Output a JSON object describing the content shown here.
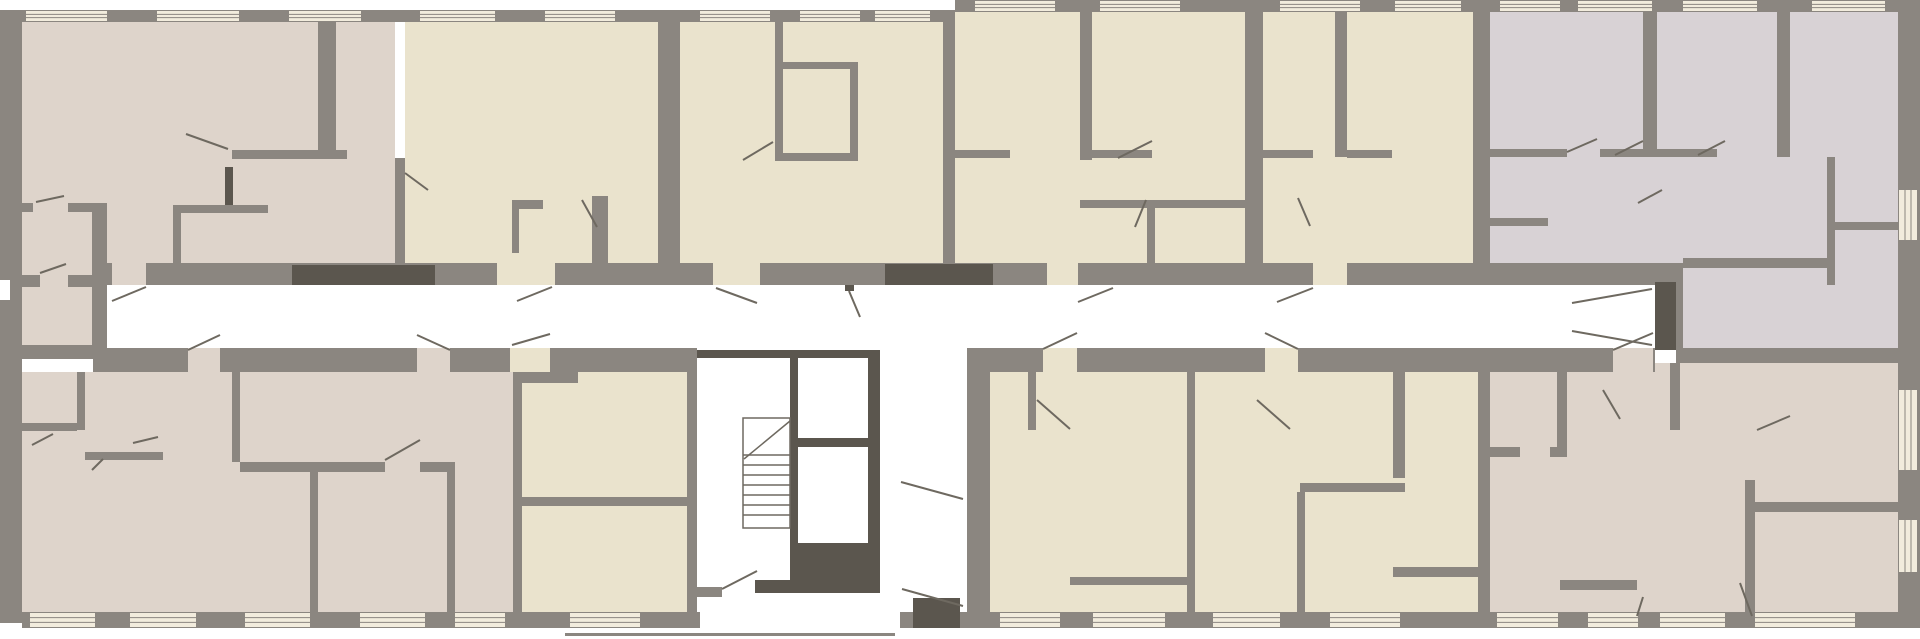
{
  "plan": {
    "width": 1920,
    "height": 639,
    "background": "#ffffff",
    "palette": {
      "wall": "#8b8680",
      "dark": "#5b564e",
      "pink": "#ded4cb",
      "cream": "#eae3cd",
      "lav": "#d8d2d5",
      "winbg": "#f2ecdd",
      "winline": "#8b8680",
      "line": "#6e6960",
      "white": "#ffffff"
    },
    "room_fills": [
      [
        22,
        22,
        373,
        241,
        "pink"
      ],
      [
        22,
        203,
        70,
        145,
        "pink"
      ],
      [
        405,
        22,
        253,
        241,
        "cream"
      ],
      [
        680,
        22,
        263,
        241,
        "cream"
      ],
      [
        955,
        12,
        290,
        251,
        "cream"
      ],
      [
        1263,
        12,
        210,
        251,
        "cream"
      ],
      [
        1490,
        12,
        408,
        273,
        "lav"
      ],
      [
        1683,
        285,
        215,
        63,
        "lav"
      ],
      [
        22,
        372,
        491,
        240,
        "pink"
      ],
      [
        522,
        372,
        165,
        240,
        "cream"
      ],
      [
        990,
        372,
        197,
        240,
        "cream"
      ],
      [
        1195,
        372,
        283,
        240,
        "cream"
      ],
      [
        1490,
        363,
        408,
        249,
        "pink"
      ]
    ],
    "walls": [
      [
        22,
        10,
        933,
        12
      ],
      [
        955,
        0,
        943,
        12
      ],
      [
        0,
        10,
        22,
        613
      ],
      [
        1898,
        0,
        22,
        628
      ],
      [
        22,
        612,
        678,
        16
      ],
      [
        900,
        612,
        1020,
        16
      ],
      [
        565,
        633,
        330,
        3
      ],
      [
        107,
        263,
        1576,
        22
      ],
      [
        93,
        348,
        604,
        24
      ],
      [
        967,
        348,
        688,
        24
      ],
      [
        22,
        345,
        85,
        14
      ],
      [
        92,
        203,
        15,
        145
      ],
      [
        22,
        275,
        85,
        12
      ],
      [
        0,
        203,
        33,
        9
      ],
      [
        68,
        203,
        24,
        9
      ],
      [
        658,
        22,
        22,
        263
      ],
      [
        943,
        12,
        12,
        273
      ],
      [
        1245,
        12,
        18,
        273
      ],
      [
        1473,
        10,
        17,
        275
      ],
      [
        318,
        22,
        18,
        135
      ],
      [
        232,
        150,
        115,
        9
      ],
      [
        395,
        158,
        10,
        105
      ],
      [
        173,
        205,
        8,
        58
      ],
      [
        173,
        205,
        95,
        8
      ],
      [
        512,
        200,
        7,
        53
      ],
      [
        512,
        200,
        31,
        9
      ],
      [
        592,
        196,
        16,
        67
      ],
      [
        775,
        22,
        8,
        138
      ],
      [
        783,
        62,
        75,
        7
      ],
      [
        850,
        62,
        8,
        98
      ],
      [
        775,
        153,
        83,
        8
      ],
      [
        1080,
        12,
        12,
        148
      ],
      [
        955,
        150,
        55,
        8
      ],
      [
        1092,
        150,
        60,
        8
      ],
      [
        1080,
        200,
        165,
        8
      ],
      [
        1147,
        208,
        8,
        55
      ],
      [
        1335,
        10,
        12,
        147
      ],
      [
        1263,
        150,
        50,
        8
      ],
      [
        1347,
        150,
        45,
        8
      ],
      [
        1643,
        10,
        14,
        147
      ],
      [
        1490,
        149,
        77,
        8
      ],
      [
        1600,
        149,
        43,
        8
      ],
      [
        1777,
        10,
        13,
        147
      ],
      [
        1657,
        149,
        60,
        8
      ],
      [
        1827,
        157,
        8,
        128
      ],
      [
        1835,
        222,
        63,
        8
      ],
      [
        1683,
        258,
        144,
        10
      ],
      [
        1490,
        218,
        58,
        8
      ],
      [
        1676,
        285,
        7,
        63
      ],
      [
        1676,
        348,
        222,
        15
      ],
      [
        513,
        372,
        9,
        240
      ],
      [
        687,
        348,
        10,
        264
      ],
      [
        967,
        372,
        23,
        240
      ],
      [
        1187,
        348,
        8,
        264
      ],
      [
        1478,
        348,
        12,
        264
      ],
      [
        77,
        372,
        8,
        58
      ],
      [
        22,
        423,
        55,
        8
      ],
      [
        232,
        372,
        8,
        90
      ],
      [
        240,
        462,
        215,
        10
      ],
      [
        310,
        472,
        8,
        140
      ],
      [
        447,
        462,
        8,
        150
      ],
      [
        85,
        452,
        78,
        8
      ],
      [
        522,
        372,
        56,
        11
      ],
      [
        522,
        497,
        165,
        9
      ],
      [
        1028,
        372,
        8,
        58
      ],
      [
        1070,
        577,
        117,
        8
      ],
      [
        1393,
        348,
        12,
        130
      ],
      [
        1300,
        483,
        105,
        9
      ],
      [
        1297,
        492,
        8,
        120
      ],
      [
        1393,
        567,
        85,
        10
      ],
      [
        1557,
        363,
        10,
        84
      ],
      [
        1490,
        447,
        77,
        10
      ],
      [
        1670,
        363,
        10,
        67
      ],
      [
        1745,
        480,
        10,
        132
      ],
      [
        1755,
        502,
        143,
        10
      ],
      [
        1560,
        580,
        77,
        10
      ],
      [
        695,
        587,
        27,
        10
      ]
    ],
    "door_gaps": [
      [
        112,
        263,
        34,
        22,
        "pink"
      ],
      [
        497,
        263,
        58,
        22,
        "cream"
      ],
      [
        713,
        263,
        47,
        22,
        "cream"
      ],
      [
        1047,
        263,
        31,
        22,
        "cream"
      ],
      [
        1313,
        263,
        34,
        22,
        "cream"
      ],
      [
        188,
        348,
        32,
        24,
        "pink"
      ],
      [
        417,
        348,
        33,
        24,
        "pink"
      ],
      [
        510,
        348,
        40,
        24,
        "cream"
      ],
      [
        1043,
        348,
        34,
        24,
        "cream"
      ],
      [
        1265,
        348,
        33,
        24,
        "cream"
      ],
      [
        1613,
        348,
        40,
        24,
        "pink"
      ],
      [
        385,
        462,
        35,
        10,
        "pink"
      ],
      [
        33,
        203,
        27,
        9,
        "pink"
      ],
      [
        40,
        275,
        28,
        12,
        "pink"
      ],
      [
        1567,
        149,
        33,
        8,
        "lav"
      ],
      [
        1520,
        447,
        30,
        10,
        "pink"
      ],
      [
        0,
        280,
        10,
        20,
        "white"
      ]
    ],
    "dark_blocks": [
      [
        292,
        265,
        143,
        20
      ],
      [
        885,
        264,
        108,
        21
      ],
      [
        845,
        285,
        9,
        6
      ],
      [
        1655,
        282,
        21,
        68
      ],
      [
        225,
        167,
        8,
        38
      ],
      [
        697,
        350,
        183,
        8
      ],
      [
        790,
        358,
        8,
        222
      ],
      [
        868,
        358,
        12,
        222
      ],
      [
        798,
        438,
        70,
        9
      ],
      [
        790,
        543,
        90,
        50
      ],
      [
        755,
        580,
        35,
        13
      ],
      [
        913,
        598,
        47,
        30
      ]
    ],
    "windows": [
      [
        26,
        11,
        81,
        10,
        "h"
      ],
      [
        157,
        11,
        82,
        10,
        "h"
      ],
      [
        289,
        11,
        72,
        10,
        "h"
      ],
      [
        420,
        11,
        75,
        10,
        "h"
      ],
      [
        545,
        11,
        70,
        10,
        "h"
      ],
      [
        700,
        11,
        70,
        10,
        "h"
      ],
      [
        800,
        11,
        60,
        10,
        "h"
      ],
      [
        875,
        11,
        55,
        10,
        "h"
      ],
      [
        975,
        1,
        80,
        10,
        "h"
      ],
      [
        1100,
        1,
        80,
        10,
        "h"
      ],
      [
        1280,
        1,
        80,
        10,
        "h"
      ],
      [
        1395,
        1,
        66,
        10,
        "h"
      ],
      [
        1500,
        1,
        60,
        10,
        "h"
      ],
      [
        1578,
        1,
        74,
        10,
        "h"
      ],
      [
        1683,
        1,
        74,
        10,
        "h"
      ],
      [
        1812,
        1,
        73,
        10,
        "h"
      ],
      [
        30,
        613,
        65,
        14,
        "h"
      ],
      [
        130,
        613,
        66,
        14,
        "h"
      ],
      [
        245,
        613,
        65,
        14,
        "h"
      ],
      [
        360,
        613,
        65,
        14,
        "h"
      ],
      [
        455,
        613,
        50,
        14,
        "h"
      ],
      [
        570,
        613,
        70,
        14,
        "h"
      ],
      [
        1000,
        613,
        60,
        14,
        "h"
      ],
      [
        1093,
        613,
        72,
        14,
        "h"
      ],
      [
        1213,
        613,
        67,
        14,
        "h"
      ],
      [
        1330,
        613,
        70,
        14,
        "h"
      ],
      [
        1497,
        613,
        61,
        14,
        "h"
      ],
      [
        1588,
        613,
        50,
        14,
        "h"
      ],
      [
        1660,
        613,
        65,
        14,
        "h"
      ],
      [
        1755,
        613,
        100,
        14,
        "h"
      ],
      [
        1899,
        190,
        18,
        50,
        "v"
      ],
      [
        1899,
        390,
        18,
        80,
        "v"
      ],
      [
        1899,
        520,
        18,
        52,
        "v"
      ]
    ],
    "door_swings": [
      [
        146,
        287,
        112,
        301
      ],
      [
        552,
        287,
        517,
        301
      ],
      [
        716,
        288,
        757,
        303
      ],
      [
        849,
        291,
        860,
        317
      ],
      [
        1113,
        288,
        1078,
        302
      ],
      [
        1313,
        288,
        1277,
        302
      ],
      [
        1652,
        289,
        1572,
        303
      ],
      [
        1652,
        345,
        1572,
        331
      ],
      [
        220,
        335,
        188,
        350
      ],
      [
        417,
        335,
        450,
        350
      ],
      [
        512,
        345,
        550,
        334
      ],
      [
        1077,
        333,
        1043,
        349
      ],
      [
        1265,
        333,
        1298,
        349
      ],
      [
        1653,
        333,
        1613,
        350
      ],
      [
        722,
        589,
        757,
        571
      ],
      [
        963,
        499,
        901,
        482
      ],
      [
        963,
        606,
        902,
        589
      ],
      [
        228,
        149,
        186,
        134
      ],
      [
        36,
        202,
        64,
        196
      ],
      [
        405,
        173,
        428,
        190
      ],
      [
        743,
        160,
        773,
        142
      ],
      [
        1118,
        158,
        1152,
        141
      ],
      [
        1135,
        227,
        1146,
        200
      ],
      [
        1615,
        155,
        1643,
        141
      ],
      [
        1698,
        155,
        1725,
        141
      ],
      [
        1638,
        203,
        1662,
        190
      ],
      [
        1298,
        198,
        1310,
        226
      ],
      [
        1603,
        390,
        1620,
        419
      ],
      [
        1757,
        430,
        1790,
        416
      ],
      [
        1740,
        583,
        1752,
        616
      ],
      [
        1637,
        616,
        1643,
        597
      ],
      [
        32,
        445,
        53,
        434
      ],
      [
        92,
        470,
        103,
        459
      ],
      [
        133,
        443,
        158,
        437
      ],
      [
        1037,
        400,
        1070,
        429
      ],
      [
        1257,
        400,
        1290,
        429
      ],
      [
        385,
        460,
        420,
        440
      ],
      [
        40,
        273,
        66,
        264
      ],
      [
        1567,
        152,
        1597,
        139
      ],
      [
        582,
        200,
        597,
        227
      ]
    ],
    "stairs": {
      "x": 743,
      "y": 418,
      "w": 47,
      "h": 110,
      "treads_y": [
        455,
        465,
        475,
        485,
        495,
        505,
        515
      ],
      "diagonal": [
        744,
        459,
        790,
        421
      ]
    }
  }
}
